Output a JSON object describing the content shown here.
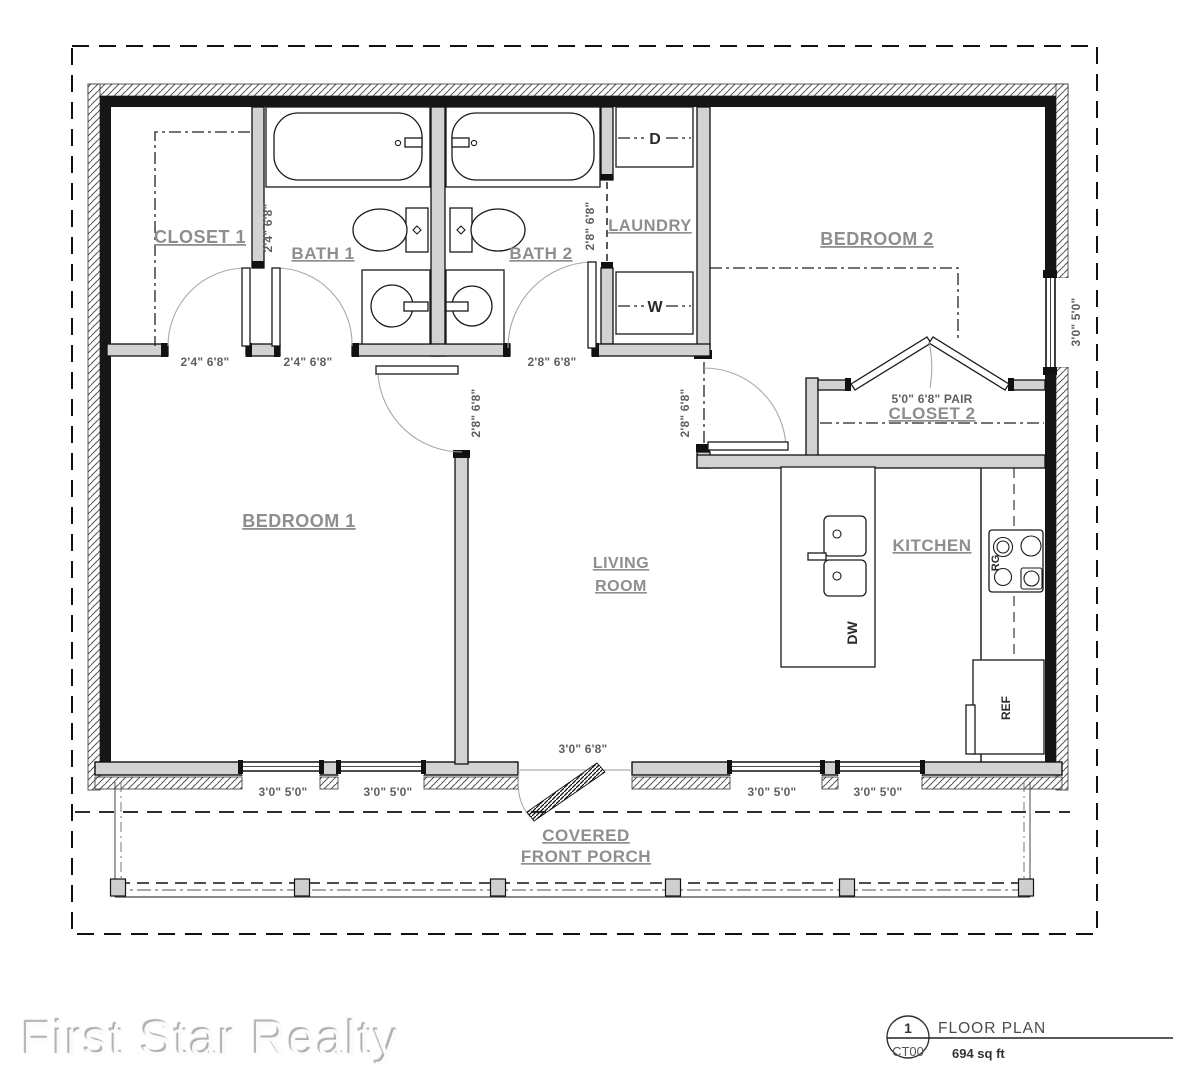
{
  "branding": {
    "logo_text": "First Star Realty"
  },
  "title_block": {
    "detail_number": "1",
    "sheet_ref": "CT00",
    "drawing_title": "FLOOR PLAN",
    "area_label": "694 sq ft"
  },
  "rooms": {
    "closet1": "CLOSET 1",
    "bath1": "BATH 1",
    "bath2": "BATH 2",
    "laundry": "LAUNDRY",
    "bedroom2": "BEDROOM 2",
    "closet2": "CLOSET 2",
    "bedroom1": "BEDROOM 1",
    "living_line1": "LIVING",
    "living_line2": "ROOM",
    "kitchen": "KITCHEN",
    "porch_line1": "COVERED",
    "porch_line2": "FRONT PORCH"
  },
  "appliances": {
    "dryer": "D",
    "washer": "W",
    "dishwasher": "DW",
    "range": "RG",
    "refrigerator": "REF"
  },
  "dimensions": {
    "closet1_door": "2'4\" 6'8\"",
    "bath1_door": "2'4\" 6'8\"",
    "bath1_door_side": "2'4\" 6'8\"",
    "bath2_door": "2'8\" 6'8\"",
    "laundry_door": "2'8\" 6'8\"",
    "bedroom1_door": "2'8\" 6'8\"",
    "bedroom2_door": "2'8\" 6'8\"",
    "closet2_doors": "5'0\" 6'8\" PAIR",
    "bedroom2_window": "3'0\" 5'0\"",
    "front_door": "3'0\" 6'8\"",
    "window_a": "3'0\" 5'0\"",
    "window_b": "3'0\" 5'0\"",
    "window_c": "3'0\" 5'0\"",
    "window_d": "3'0\" 5'0\""
  },
  "colors": {
    "room_label": "#8e8e8e",
    "dimension_text": "#5f5f5f",
    "wall_fill": "#d2d2d2",
    "line": "#161616",
    "logo_text": "#fbfbfb"
  }
}
